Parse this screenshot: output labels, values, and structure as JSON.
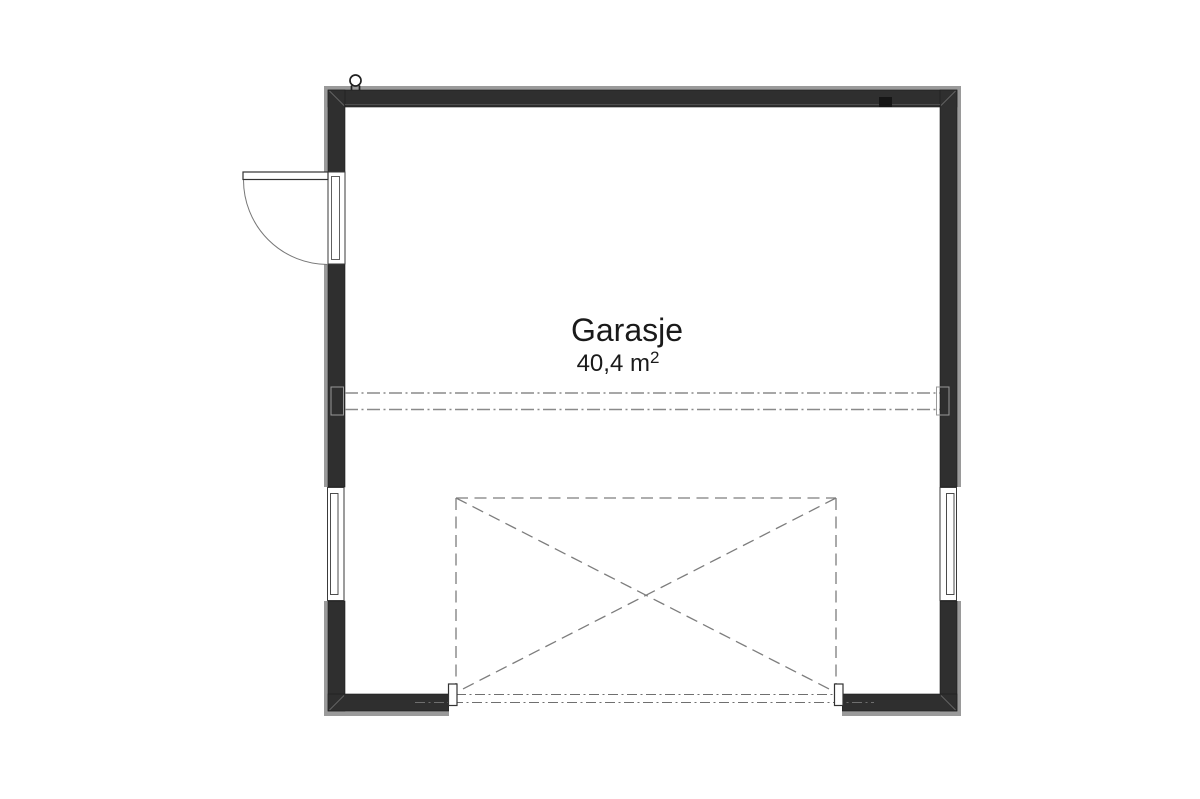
{
  "room": {
    "name": "Garasje",
    "area_value": "40,4 m",
    "area_superscript": "2"
  },
  "colors": {
    "background": "#ffffff",
    "wall": "#2f2f2f",
    "cladding": "#9a9a9a",
    "outline": "#3a3a3a",
    "dash_gray": "#7d7d7d",
    "dashdot_gray": "#8a8a8a",
    "text": "#1a1a1a"
  }
}
